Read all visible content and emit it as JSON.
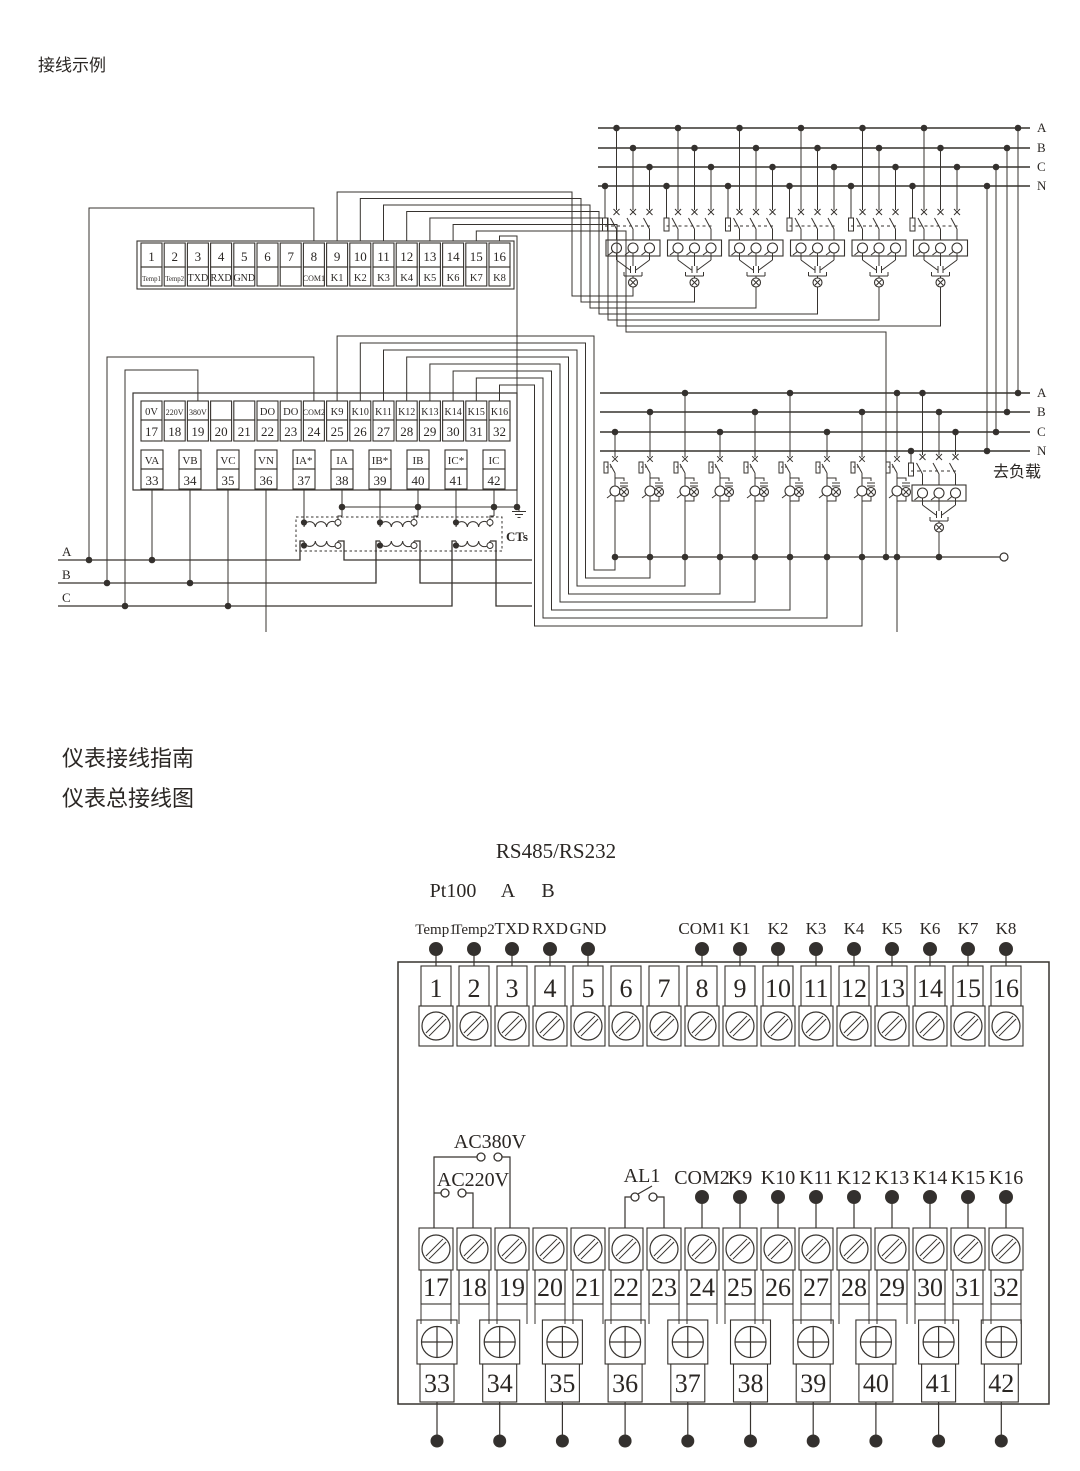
{
  "titles": {
    "wiring_example": "接线示例",
    "guide": "仪表接线指南",
    "overall": "仪表总接线图"
  },
  "labels": {
    "cts": "CTs",
    "to_load": "去负载",
    "rs485": "RS485/RS232",
    "pt100": "Pt100",
    "rs_a": "A",
    "rs_b": "B",
    "ac380": "AC380V",
    "ac220": "AC220V",
    "al1": "AL1"
  },
  "bus": {
    "top": [
      "A",
      "B",
      "C",
      "N"
    ],
    "mid": [
      "A",
      "B",
      "C",
      "N"
    ],
    "left": [
      "A",
      "B",
      "C"
    ]
  },
  "top_block": {
    "row1_numbers": [
      "1",
      "2",
      "3",
      "4",
      "5",
      "6",
      "7",
      "8",
      "9",
      "10",
      "11",
      "12",
      "13",
      "14",
      "15",
      "16"
    ],
    "row1_labels": [
      "Temp1",
      "Temp2",
      "TXD",
      "RXD",
      "GND",
      "",
      "",
      "COM1",
      "K1",
      "K2",
      "K3",
      "K4",
      "K5",
      "K6",
      "K7",
      "K8"
    ],
    "row2_labels": [
      "0V",
      "220V",
      "380V",
      "",
      "",
      "DO",
      "DO",
      "COM2",
      "K9",
      "K10",
      "K11",
      "K12",
      "K13",
      "K14",
      "K15",
      "K16"
    ],
    "row2_numbers": [
      "17",
      "18",
      "19",
      "20",
      "21",
      "22",
      "23",
      "24",
      "25",
      "26",
      "27",
      "28",
      "29",
      "30",
      "31",
      "32"
    ],
    "row3_labels": [
      "VA",
      "VB",
      "VC",
      "VN",
      "IA*",
      "IA",
      "IB*",
      "IB",
      "IC*",
      "IC"
    ],
    "row3_numbers": [
      "33",
      "34",
      "35",
      "36",
      "37",
      "38",
      "39",
      "40",
      "41",
      "42"
    ]
  },
  "bottom_block": {
    "row1_numbers": [
      "1",
      "2",
      "3",
      "4",
      "5",
      "6",
      "7",
      "8",
      "9",
      "10",
      "11",
      "12",
      "13",
      "14",
      "15",
      "16"
    ],
    "row1_pins": [
      {
        "label": "Temp1",
        "t": 1
      },
      {
        "label": "Temp2",
        "t": 2
      },
      {
        "label": "TXD",
        "t": 3
      },
      {
        "label": "RXD",
        "t": 4
      },
      {
        "label": "GND",
        "t": 5
      },
      {
        "label": "COM1",
        "t": 8
      },
      {
        "label": "K1",
        "t": 9
      },
      {
        "label": "K2",
        "t": 10
      },
      {
        "label": "K3",
        "t": 11
      },
      {
        "label": "K4",
        "t": 12
      },
      {
        "label": "K5",
        "t": 13
      },
      {
        "label": "K6",
        "t": 14
      },
      {
        "label": "K7",
        "t": 15
      },
      {
        "label": "K8",
        "t": 16
      }
    ],
    "row2_numbers": [
      "17",
      "18",
      "19",
      "20",
      "21",
      "22",
      "23",
      "24",
      "25",
      "26",
      "27",
      "28",
      "29",
      "30",
      "31",
      "32"
    ],
    "row2_pins": [
      {
        "label": "COM2",
        "t": 24
      },
      {
        "label": "K9",
        "t": 25
      },
      {
        "label": "K10",
        "t": 26
      },
      {
        "label": "K11",
        "t": 27
      },
      {
        "label": "K12",
        "t": 28
      },
      {
        "label": "K13",
        "t": 29
      },
      {
        "label": "K14",
        "t": 30
      },
      {
        "label": "K15",
        "t": 31
      },
      {
        "label": "K16",
        "t": 32
      }
    ],
    "row3_numbers": [
      "33",
      "34",
      "35",
      "36",
      "37",
      "38",
      "39",
      "40",
      "41",
      "42"
    ]
  }
}
